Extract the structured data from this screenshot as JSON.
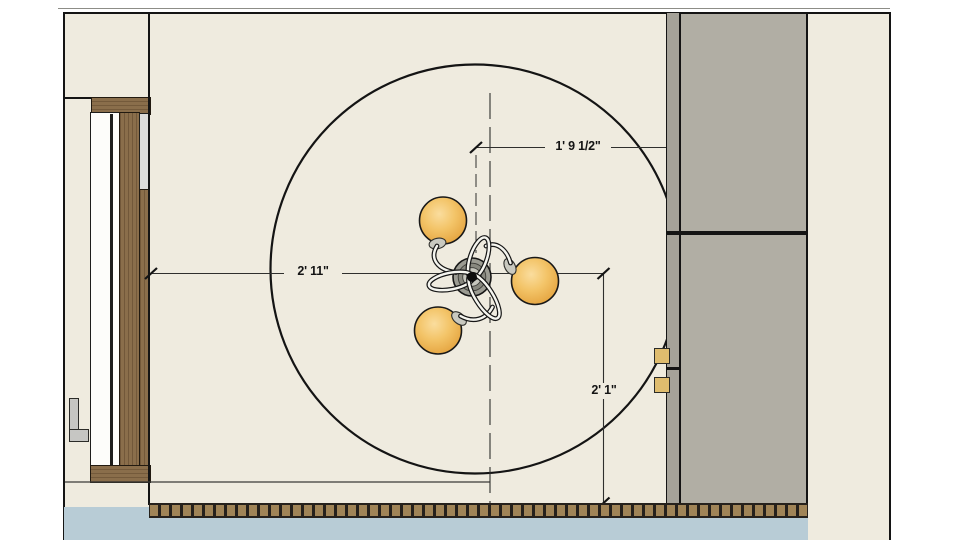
{
  "dimensions": {
    "top": {
      "label": "1' 9 1/2\""
    },
    "middle": {
      "label": "2' 11\""
    },
    "right": {
      "label": "2' 1\""
    }
  },
  "colors": {
    "cream": "#efebdf",
    "line": "#141414",
    "panel": "#b1aea4",
    "strip": "#a5a299",
    "wood": "#8a6e4b",
    "glass": "#dcdcda",
    "blue": "#b8ccd6",
    "hatch-bg": "#26211c",
    "hatch-sq": "#a08457",
    "globe": "#f3c468",
    "hinge": "#dfbc6e",
    "handle": "#c6c6c3"
  }
}
